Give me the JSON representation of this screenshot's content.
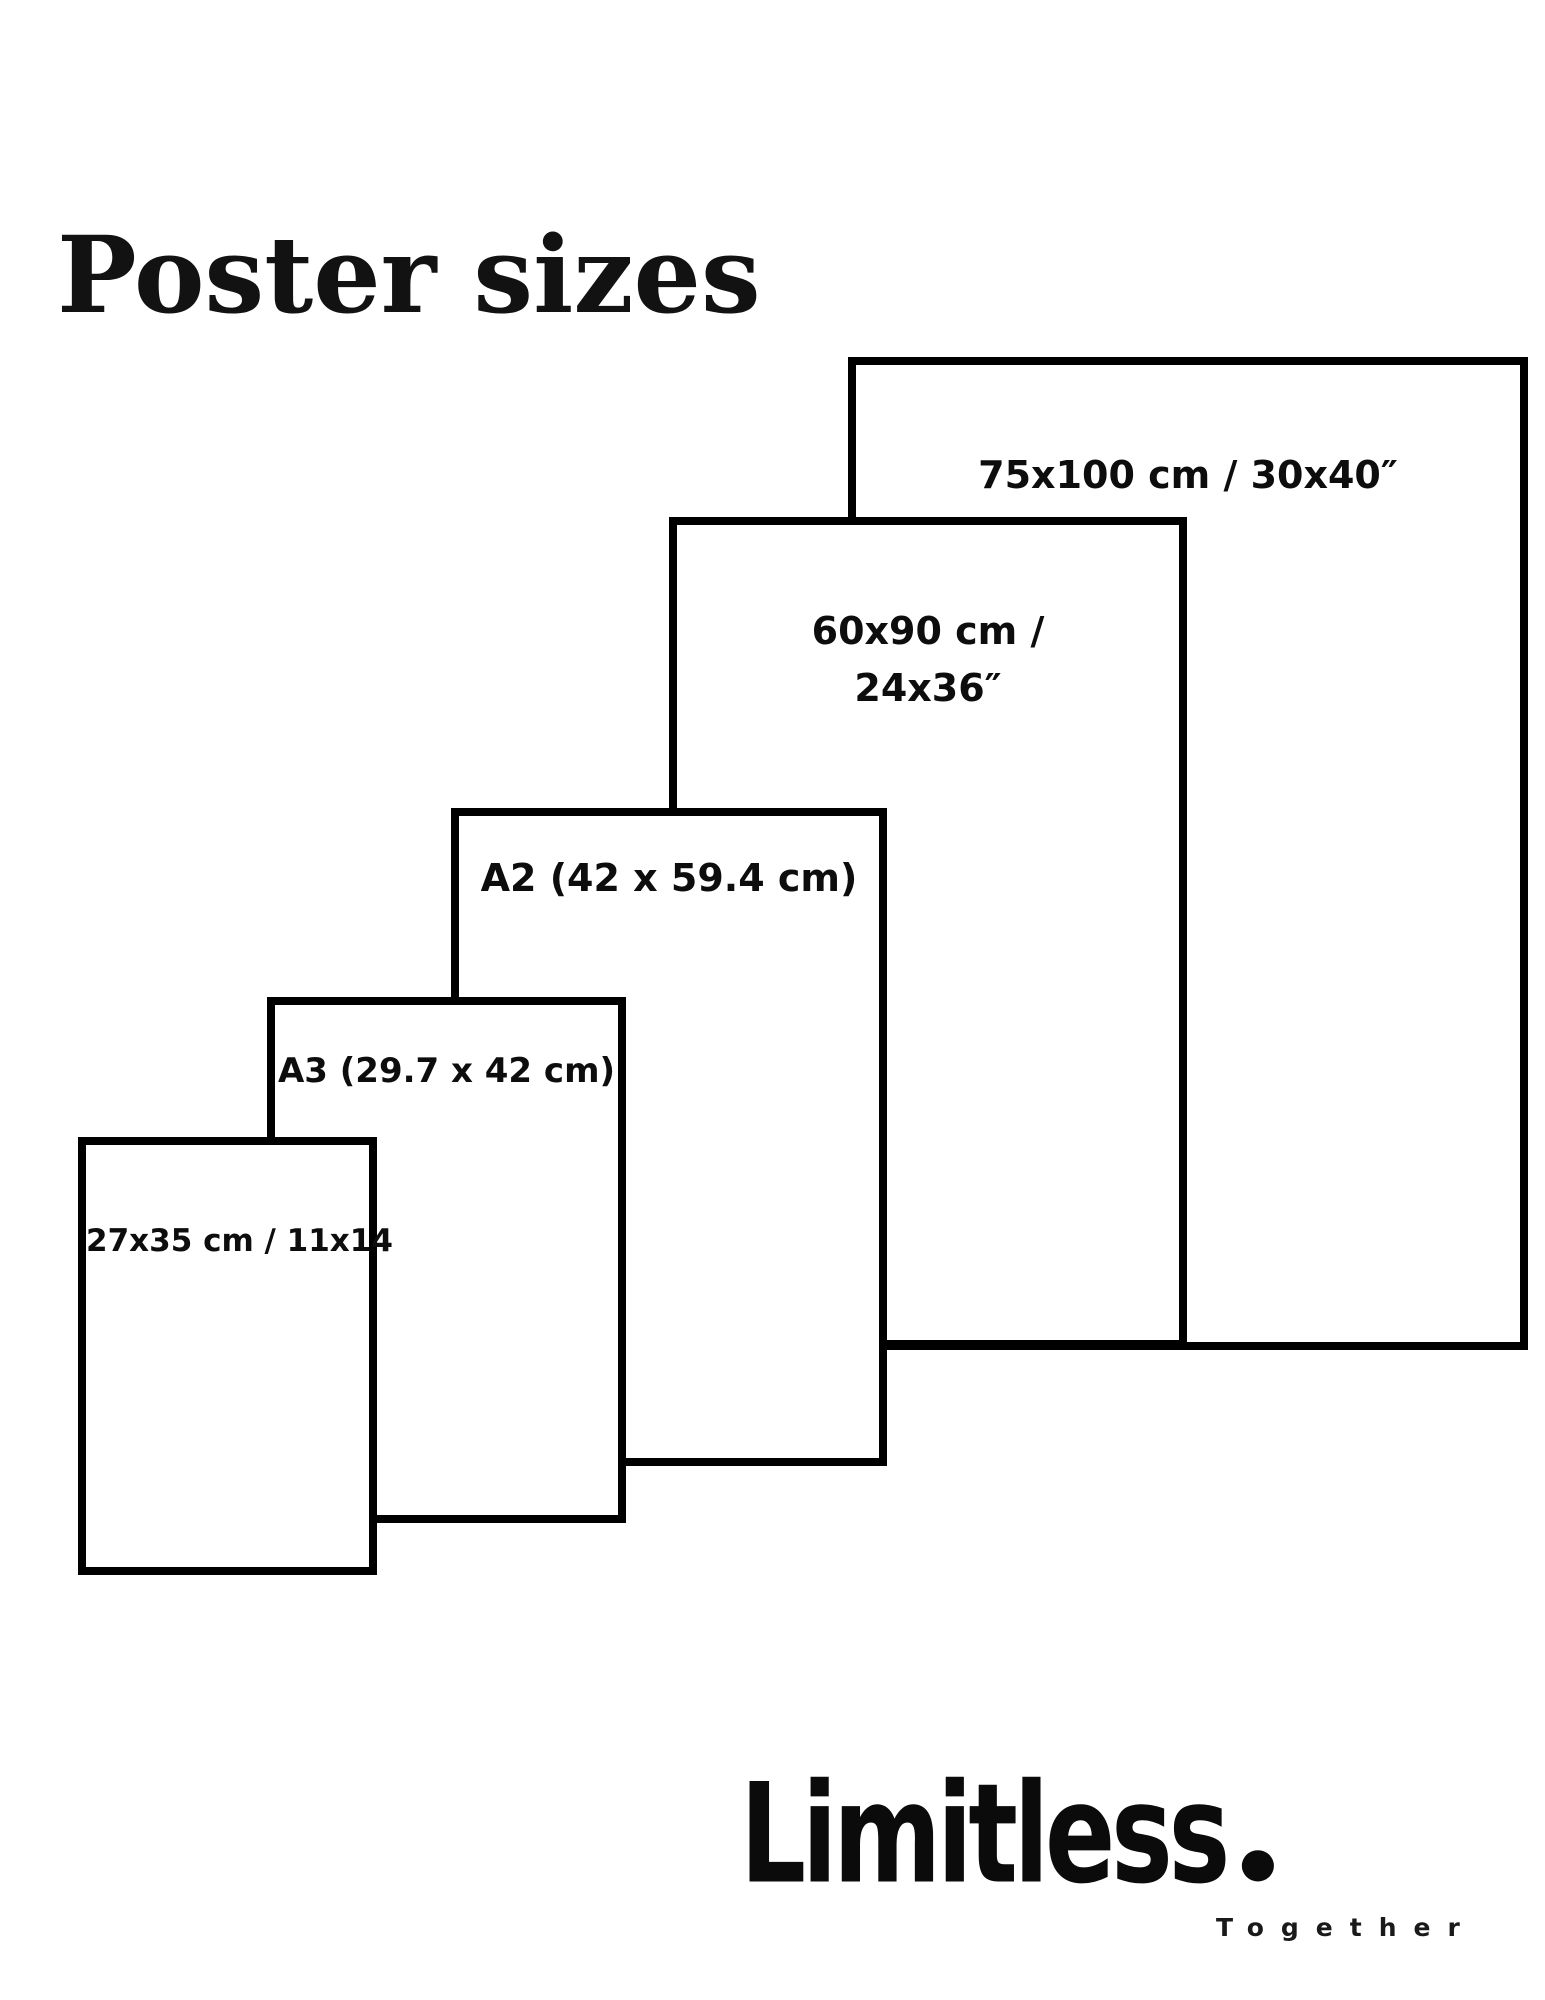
{
  "title": "Poster sizes",
  "posters": [
    {
      "name": "75x100",
      "lines": [
        "75x100 cm / 30x40″"
      ]
    },
    {
      "name": "60x90",
      "lines": [
        "60x90 cm /",
        "24x36″"
      ]
    },
    {
      "name": "A2",
      "lines": [
        "A2 (42 x 59.4 cm)"
      ]
    },
    {
      "name": "A3",
      "lines": [
        "A3 (29.7 x 42 cm)"
      ]
    },
    {
      "name": "27x35",
      "lines": [
        "27x35 cm / 11x14"
      ]
    }
  ],
  "logo": {
    "brand": "Limitless",
    "tagline": "Together"
  },
  "colors": {
    "background": "#ffffff",
    "border": "#000000",
    "text": "#000000"
  }
}
